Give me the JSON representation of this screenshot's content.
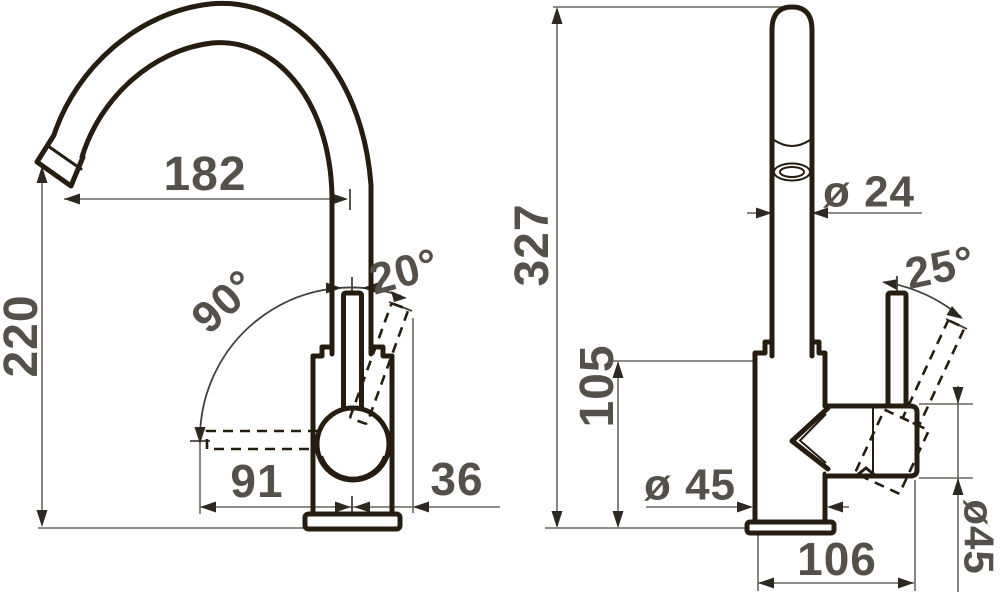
{
  "drawing": {
    "colors": {
      "object_line": "#261c10",
      "dimension_line": "#6a665e",
      "label_text": "#55514a",
      "background": "#ffffff"
    },
    "front_view": {
      "spout_reach": "182",
      "spout_height": "220",
      "swivel_angle": "90°",
      "lever_tilt_angle": "20°",
      "spout_offset": "91",
      "lever_offset": "36"
    },
    "side_view": {
      "total_height": "327",
      "spout_diameter": "ø 24",
      "lever_angle": "25°",
      "body_height": "105",
      "body_diameter": "ø 45",
      "handle_diameter": "ø45",
      "base_depth": "106"
    }
  }
}
